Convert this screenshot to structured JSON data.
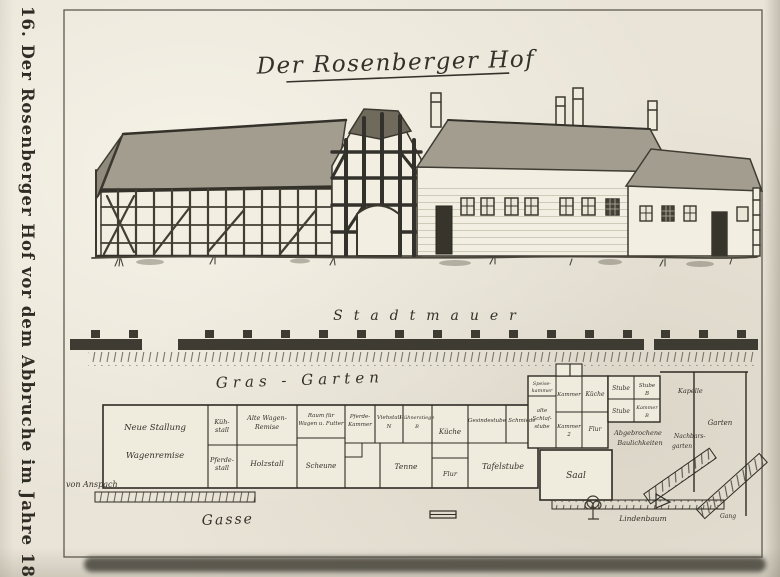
{
  "plate": {
    "margin_caption": "16. Der Rosenberger Hof vor dem Abbruche im Jahre 1849.",
    "title": "Der Rosenberger Hof"
  },
  "site_plan": {
    "stadtmauer": "Stadtmauer",
    "gras_garten": "Gras - Garten",
    "gasse": "Gasse",
    "von_anspach": "von Anspach",
    "lindenbaum": "Lindenbaum",
    "kapelle": "Kapelle",
    "garten": "Garten",
    "nachbars_garten_line1": "Nachbars-",
    "nachbars_garten_line2": "garten",
    "abgebrochene_line1": "Abgebrochene",
    "abgebrochene_line2": "Baulichkeiten",
    "gang": "Gang",
    "rooms": {
      "neue_stallung": "Neue Stallung",
      "wagenremise": "Wagenremise",
      "kuehstall_1": "Küh-",
      "kuehstall_2": "stall",
      "pferdestall_1": "Pferde-",
      "pferdestall_2": "stall",
      "alte_wagenremise_1": "Alte Wagen-",
      "alte_wagenremise_2": "Remise",
      "holzstall": "Holzstall",
      "raum_fuer_1": "Raum für",
      "raum_fuer_2": "Wagen u. Futter",
      "scheune_links": "Scheune",
      "pferdekammer_1": "Pferde-",
      "pferdekammer_2": "Kammer",
      "viehstall_1": "Viehstall",
      "viehstall_2": "N",
      "huehnerstiege_1": "Hühnerstiege",
      "huehnerstiege_2": "B",
      "kueche": "Küche",
      "gesindestube": "Gesindestube",
      "schmiede": "Schmiede",
      "tenne": "Tenne",
      "flur": "Flur",
      "tafelstube": "Tafelstube",
      "saal": "Saal",
      "speisekammer_1": "Speise-",
      "speisekammer_2": "kammer",
      "alte_schlafstube_1": "alte",
      "alte_schlafstube_2": "Schlaf-",
      "alte_schlafstube_3": "stube",
      "kammer_a": "Kammer",
      "kueche_b": "Küche",
      "stube_a": "Stube",
      "stube_b_1": "Stube",
      "stube_b_2": "B",
      "kammer_2_1": "Kammer",
      "kammer_2_2": "2",
      "flur_2": "Flur",
      "stube_c": "Stube",
      "kammer_b_1": "Kammer",
      "kammer_b_2": "B"
    }
  },
  "colors": {
    "paper": "#e9e4d7",
    "ink": "#2f2c25",
    "roof_fill": "#a39d8f",
    "timber": "#33312b",
    "shadow_band": "#514e45"
  }
}
